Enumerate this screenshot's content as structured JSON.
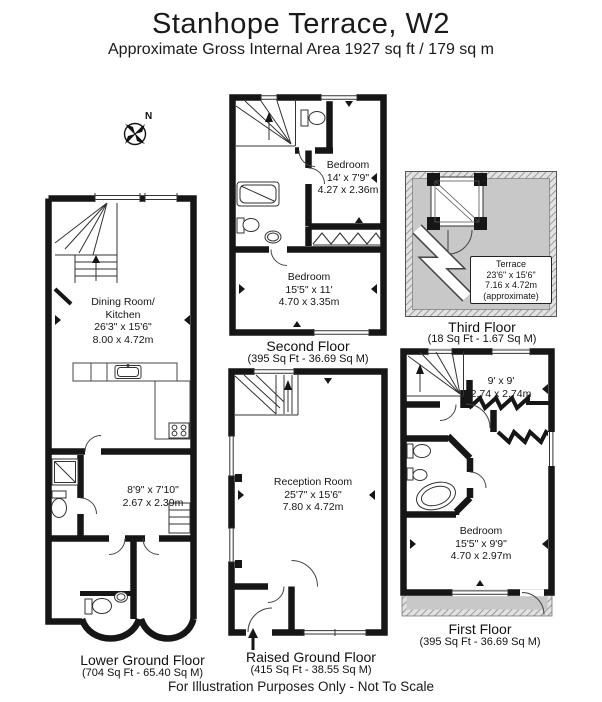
{
  "header": {
    "title": "Stanhope Terrace, W2",
    "subtitle": "Approximate Gross Internal Area 1927 sq ft / 179 sq m"
  },
  "compass": {
    "north_label": "N"
  },
  "floors": {
    "lower_ground": {
      "name": "Lower Ground Floor",
      "area": "(704 Sq Ft - 65.40 Sq M)",
      "dining_kitchen": "Dining Room/\nKitchen\n26'3\" x 15'6\"\n8.00 x 4.72m",
      "store": "8'9\" x 7'10\"\n2.67 x 2.39m"
    },
    "raised_ground": {
      "name": "Raised Ground Floor",
      "area": "(415 Sq Ft - 38.55 Sq M)",
      "reception": "Reception Room\n25'7\" x 15'6\"\n7.80 x 4.72m"
    },
    "first": {
      "name": "First Floor",
      "area": "(395 Sq Ft - 36.69 Sq M)",
      "room": "9' x 9'\n2.74 x 2.74m",
      "bedroom": "Bedroom\n15'5\" x 9'9\"\n4.70 x 2.97m"
    },
    "second": {
      "name": "Second Floor",
      "area": "(395 Sq Ft - 36.69 Sq M)",
      "bedroom1": "Bedroom\n14' x 7'9\"\n4.27 x 2.36m",
      "bedroom2": "Bedroom\n15'5\" x 11'\n4.70 x 3.35m"
    },
    "third": {
      "name": "Third Floor",
      "area": "(18 Sq Ft - 1.67 Sq M)",
      "terrace": "Terrace\n23'6\" x 15'6\"\n7.16 x 4.72m\n(approximate)"
    }
  },
  "footer": "For Illustration Purposes Only - Not To Scale"
}
